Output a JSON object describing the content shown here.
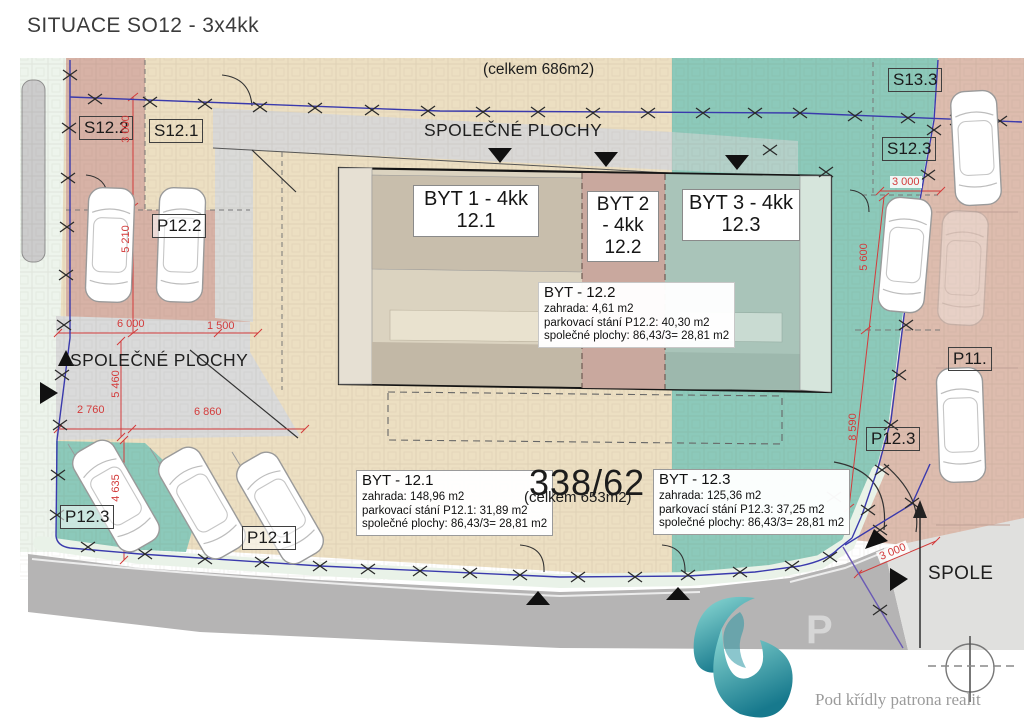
{
  "title": "SITUACE SO12 - 3x4kk",
  "annotations": {
    "top_total": "(celkem 686m2)",
    "parcel_number": "338/62",
    "parcel_total": "(celkem 653m2)"
  },
  "common_areas": {
    "top": "SPOLEČNÉ PLOCHY",
    "left": "SPOLEČNÉ PLOCHY",
    "right": "SPOLE"
  },
  "units": [
    {
      "name": "BYT 1 - 4kk",
      "number": "12.1"
    },
    {
      "name": "BYT 2 - 4kk",
      "number": "12.2"
    },
    {
      "name": "BYT 3 - 4kk",
      "number": "12.3"
    }
  ],
  "info_boxes": [
    {
      "title": "BYT - 12.1",
      "lines": [
        "zahrada: 148,96 m2",
        "parkovací stání P12.1: 31,89 m2",
        "společné plochy: 86,43/3= 28,81 m2"
      ]
    },
    {
      "title": "BYT - 12.2",
      "lines": [
        "zahrada: 4,61 m2",
        "parkovací stání P12.2: 40,30 m2",
        "společné plochy: 86,43/3= 28,81 m2"
      ]
    },
    {
      "title": "BYT - 12.3",
      "lines": [
        "zahrada: 125,36 m2",
        "parkovací stání P12.3: 37,25 m2",
        "společné plochy: 86,43/3= 28,81 m2"
      ]
    }
  ],
  "plots": {
    "s12_2": "S12.2",
    "s12_1": "S12.1",
    "p12_2": "P12.2",
    "s13_3": "S13.3",
    "s12_3": "S12.3",
    "p11": "P11.",
    "p12_3_right": "P12.3",
    "p12_3_left": "P12.3",
    "p12_1": "P12.1"
  },
  "dims": {
    "left_v1": "3 000",
    "left_v2": "5 210",
    "left_h1": "6 000",
    "left_h2": "1 500",
    "left_v3": "5 460",
    "bottom_h1": "2 760",
    "bottom_h2": "6 860",
    "bottom_v": "4 635",
    "right_h": "3 000",
    "right_v1": "5 600",
    "right_v2": "8 590",
    "bottom_right": "3 000"
  },
  "logo": {
    "tagline": "Pod křídly patrona realit"
  },
  "watermark": "P",
  "colors": {
    "tan": "#ecdfc2",
    "teal": "#8cc9ba",
    "pink_left": "#d7b2a6",
    "pink_right": "#ddbcae",
    "road_gray": "#b5b4b4",
    "boundary_blue": "#3a3aad",
    "dimension_red": "#d33b3b",
    "logo_teal": "#1f8f9b"
  }
}
